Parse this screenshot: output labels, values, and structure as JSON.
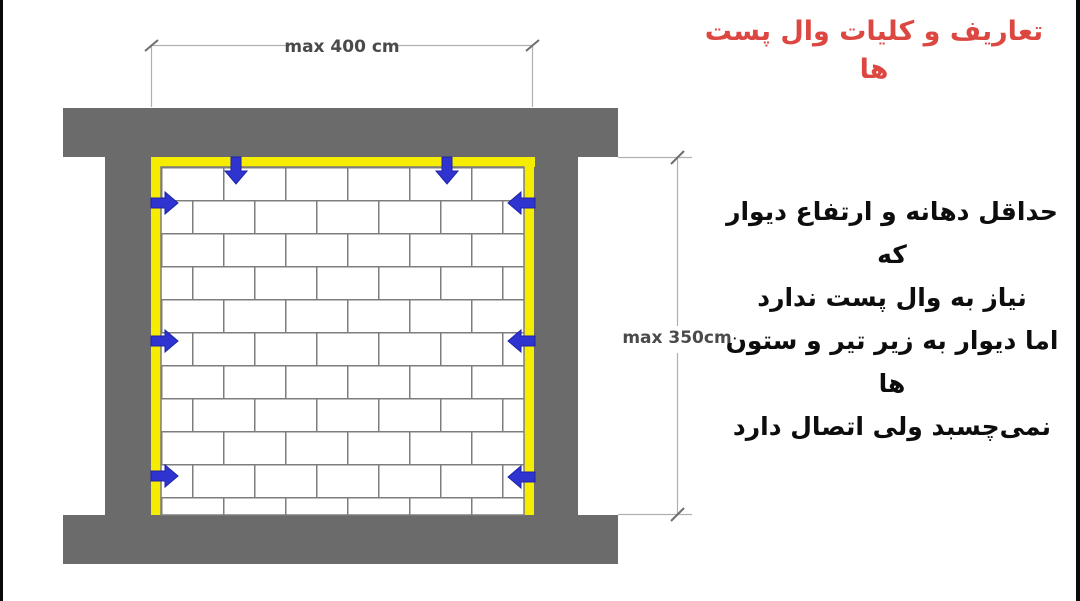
{
  "slide": {
    "title": "تعاریف و کلیات وال پست ها",
    "body_lines": [
      "حداقل دهانه و ارتفاع دیوار که",
      "نیاز به وال پست ندارد",
      "اما دیوار به زیر تیر و ستون ها",
      "نمی‌چسبد ولی اتصال دارد"
    ]
  },
  "diagram": {
    "width_dimension": "max 400 cm",
    "height_dimension": "max 350cm",
    "colors": {
      "concrete_gray": "#6b6b6b",
      "wallpost_yellow": "#f6ec00",
      "arrow_blue": "#2f33d0",
      "brick_joint": "#7d7d7d",
      "dimension_line": "#b0b0b0",
      "dimension_text": "#4a4a4a",
      "title_red": "#dd4742",
      "body_text": "#0d0d0d"
    }
  }
}
